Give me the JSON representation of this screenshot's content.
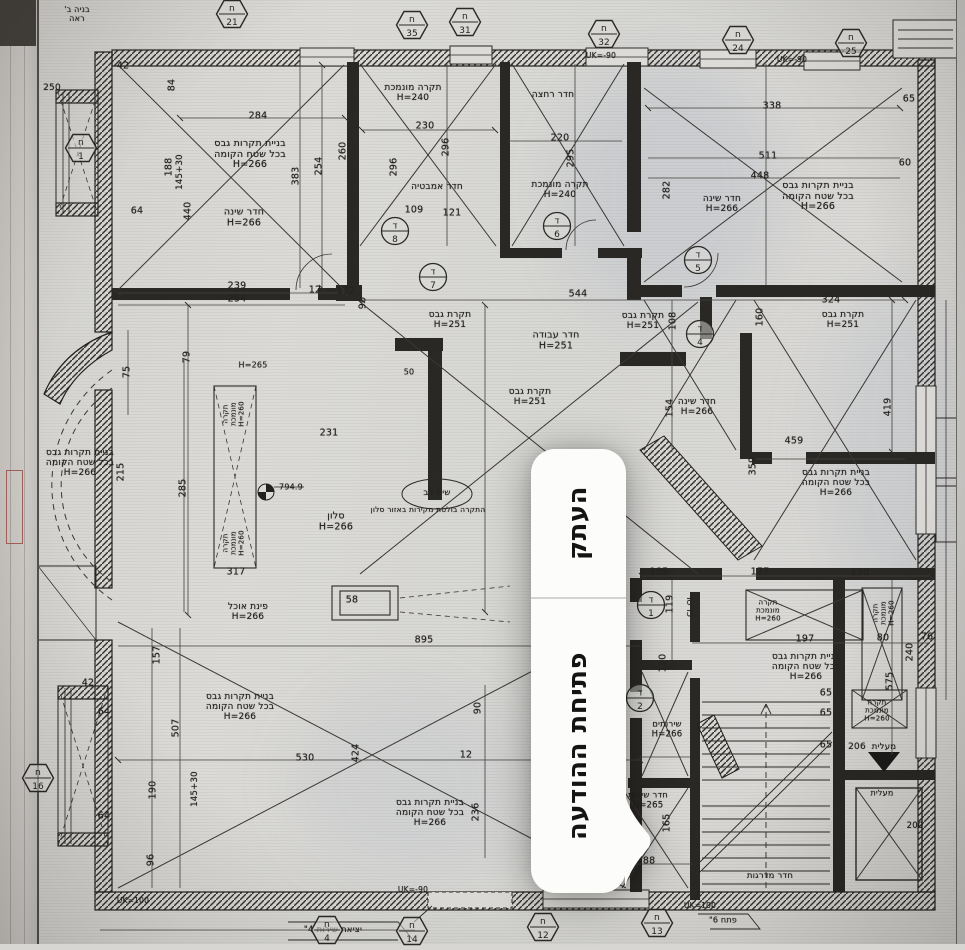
{
  "context_menu": {
    "items": [
      {
        "label": "העתק"
      },
      {
        "label": "פתיחת ההודעה"
      }
    ]
  },
  "plan": {
    "labels": [
      {
        "t": "בניית תקרות גבס\nבכל שטח הקומה\nH=266",
        "x": 250,
        "y": 155
      },
      {
        "t": "בניית תקרות גבס\nבכל שטח הקומה\nH=266",
        "x": 818,
        "y": 197
      },
      {
        "t": "בניית תקרות גבס\nבכל שטח הקומה\nH=266",
        "x": 80,
        "y": 463,
        "s": 9
      },
      {
        "t": "בניית תקרות גבס\nבכל שטח הקומה\nH=266",
        "x": 836,
        "y": 483,
        "s": 9
      },
      {
        "t": "בניית תקרות גבס\nבכל שטח הקומה\nH=266",
        "x": 806,
        "y": 667,
        "s": 9
      },
      {
        "t": "בניית תקרות גבס\nבכל שטח הקומה\nH=266",
        "x": 240,
        "y": 707,
        "s": 9
      },
      {
        "t": "בניית תקרות גבס\nבכל שטח הקומה\nH=266",
        "x": 430,
        "y": 813,
        "s": 9
      },
      {
        "t": "חדר שינה\nH=266",
        "x": 244,
        "y": 218
      },
      {
        "t": "חדר שינה\nH=266",
        "x": 722,
        "y": 204,
        "s": 9
      },
      {
        "t": "חדר שינה\nH=266",
        "x": 697,
        "y": 407,
        "s": 9
      },
      {
        "t": "חדר עבודה\nH=251",
        "x": 556,
        "y": 341
      },
      {
        "t": "תקרת גבס\nH=251",
        "x": 450,
        "y": 320,
        "s": 9
      },
      {
        "t": "תקרת גבס\nH=251",
        "x": 643,
        "y": 321,
        "s": 9
      },
      {
        "t": "תקרת גבס\nH=251",
        "x": 530,
        "y": 397,
        "s": 9
      },
      {
        "t": "תקרת גבס\nH=251",
        "x": 843,
        "y": 320,
        "s": 9
      },
      {
        "t": "תקרה מונמכת\nH=240",
        "x": 413,
        "y": 93,
        "s": 9
      },
      {
        "t": "תקרה מונמכת\nH=240",
        "x": 560,
        "y": 190,
        "s": 9
      },
      {
        "t": "חדר רחצה",
        "x": 553,
        "y": 95,
        "s": 9
      },
      {
        "t": "חדר אמבטיה",
        "x": 437,
        "y": 187,
        "s": 9
      },
      {
        "t": "סלון\nH=266",
        "x": 336,
        "y": 522
      },
      {
        "t": "פינת אוכל\nH=266",
        "x": 248,
        "y": 612,
        "s": 9
      },
      {
        "t": "שירותים\nH=266",
        "x": 667,
        "y": 730,
        "s": 8.5
      },
      {
        "t": "חדר שירות\nH=265",
        "x": 648,
        "y": 801,
        "s": 8.5
      },
      {
        "t": "חדר מדרגות",
        "x": 770,
        "y": 877,
        "s": 8.5
      },
      {
        "t": "מעלית",
        "x": 884,
        "y": 748,
        "s": 8.5
      },
      {
        "t": "206",
        "x": 857,
        "y": 747,
        "s": 9
      },
      {
        "t": "מעלית",
        "x": 882,
        "y": 794,
        "s": 8
      },
      {
        "t": "200",
        "x": 915,
        "y": 827,
        "s": 8.5
      },
      {
        "t": "שים לב",
        "x": 437,
        "y": 494,
        "s": 8.5
      },
      {
        "t": "התקרה בולטת מקירות באזור סלון",
        "x": 428,
        "y": 510,
        "s": 7.5
      },
      {
        "t": "794.9",
        "x": 291,
        "y": 488,
        "s": 8
      },
      {
        "t": "H=265",
        "x": 253,
        "y": 366,
        "s": 8
      },
      {
        "t": "יציאת שירות 4\"",
        "x": 333,
        "y": 931,
        "s": 8.5
      },
      {
        "t": "פתח 6\"",
        "x": 723,
        "y": 921,
        "s": 8
      },
      {
        "t": "UK=100",
        "x": 133,
        "y": 901,
        "s": 7.5
      },
      {
        "t": "UK=-90",
        "x": 413,
        "y": 890,
        "s": 7.5
      },
      {
        "t": "UK=100",
        "x": 700,
        "y": 906,
        "s": 7.5
      },
      {
        "t": "UK=-90",
        "x": 601,
        "y": 56,
        "s": 7.5
      },
      {
        "t": "UK=-90",
        "x": 792,
        "y": 60,
        "s": 7.5
      },
      {
        "t": "CL.OL",
        "x": 691,
        "y": 606,
        "r": -90,
        "s": 7
      },
      {
        "t": "תקרה\nמונמכת\nH=260",
        "x": 768,
        "y": 611,
        "s": 7
      },
      {
        "t": "תקרה\nמונמכת\nH=260",
        "x": 884,
        "y": 613,
        "r": -90,
        "s": 7
      },
      {
        "t": "תקרה\nמונמכת\nH=260",
        "x": 877,
        "y": 711,
        "s": 7
      },
      {
        "t": "תקרה\nמונמכת\nH=260",
        "x": 234,
        "y": 414,
        "r": -90,
        "s": 7
      },
      {
        "t": "תקרה\nמונמכת\nH=260",
        "x": 234,
        "y": 543,
        "r": -90,
        "s": 7
      },
      {
        "t": "בניה ב'\nראה",
        "x": 77,
        "y": 15,
        "s": 8
      },
      {
        "t": "250",
        "x": 52,
        "y": 88,
        "s": 9
      },
      {
        "t": "284",
        "x": 258,
        "y": 117
      },
      {
        "t": "230",
        "x": 425,
        "y": 127
      },
      {
        "t": "220",
        "x": 560,
        "y": 139
      },
      {
        "t": "338",
        "x": 772,
        "y": 107
      },
      {
        "t": "511",
        "x": 768,
        "y": 157
      },
      {
        "t": "448",
        "x": 760,
        "y": 177
      },
      {
        "t": "239",
        "x": 237,
        "y": 287
      },
      {
        "t": "254",
        "x": 237,
        "y": 300
      },
      {
        "t": "12",
        "x": 315,
        "y": 291
      },
      {
        "t": "132",
        "x": 346,
        "y": 292
      },
      {
        "t": "544",
        "x": 578,
        "y": 295
      },
      {
        "t": "324",
        "x": 831,
        "y": 301
      },
      {
        "t": "109",
        "x": 414,
        "y": 211
      },
      {
        "t": "121",
        "x": 452,
        "y": 214
      },
      {
        "t": "65",
        "x": 909,
        "y": 100
      },
      {
        "t": "60",
        "x": 905,
        "y": 164
      },
      {
        "t": "459",
        "x": 794,
        "y": 442
      },
      {
        "t": "231",
        "x": 329,
        "y": 434
      },
      {
        "t": "895",
        "x": 424,
        "y": 641
      },
      {
        "t": "58",
        "x": 352,
        "y": 601
      },
      {
        "t": "530",
        "x": 305,
        "y": 759
      },
      {
        "t": "12",
        "x": 466,
        "y": 756
      },
      {
        "t": "190",
        "x": 606,
        "y": 756
      },
      {
        "t": "188",
        "x": 646,
        "y": 862
      },
      {
        "t": "185",
        "x": 659,
        "y": 573
      },
      {
        "t": "177",
        "x": 760,
        "y": 573
      },
      {
        "t": "150",
        "x": 860,
        "y": 574
      },
      {
        "t": "197",
        "x": 805,
        "y": 640
      },
      {
        "t": "80",
        "x": 883,
        "y": 639
      },
      {
        "t": "76",
        "x": 927,
        "y": 638
      },
      {
        "t": "65",
        "x": 826,
        "y": 694
      },
      {
        "t": "65",
        "x": 826,
        "y": 714
      },
      {
        "t": "65",
        "x": 826,
        "y": 746
      },
      {
        "t": "42",
        "x": 88,
        "y": 684
      },
      {
        "t": "64",
        "x": 104,
        "y": 713
      },
      {
        "t": "64",
        "x": 104,
        "y": 817
      },
      {
        "t": "42",
        "x": 123,
        "y": 67
      },
      {
        "t": "64",
        "x": 137,
        "y": 212
      },
      {
        "t": "317",
        "x": 236,
        "y": 573
      },
      {
        "t": "50",
        "x": 409,
        "y": 373,
        "s": 8
      },
      {
        "t": "96",
        "x": 152,
        "y": 860,
        "r": -90
      },
      {
        "t": "157",
        "x": 158,
        "y": 655,
        "r": -90
      },
      {
        "t": "507",
        "x": 177,
        "y": 728,
        "r": -90
      },
      {
        "t": "145+30",
        "x": 196,
        "y": 789,
        "r": -90,
        "s": 8.5
      },
      {
        "t": "190",
        "x": 154,
        "y": 790,
        "r": -90
      },
      {
        "t": "424",
        "x": 357,
        "y": 753,
        "r": -90
      },
      {
        "t": "236",
        "x": 477,
        "y": 812,
        "r": -90
      },
      {
        "t": "90",
        "x": 479,
        "y": 708,
        "r": -90
      },
      {
        "t": "75",
        "x": 128,
        "y": 372,
        "r": -90
      },
      {
        "t": "79",
        "x": 188,
        "y": 357,
        "r": -90
      },
      {
        "t": "215",
        "x": 122,
        "y": 472,
        "r": -90
      },
      {
        "t": "285",
        "x": 184,
        "y": 488,
        "r": -90
      },
      {
        "t": "188",
        "x": 170,
        "y": 167,
        "r": -90
      },
      {
        "t": "145+30",
        "x": 181,
        "y": 172,
        "r": -90,
        "s": 8.5
      },
      {
        "t": "440",
        "x": 189,
        "y": 211,
        "r": -90
      },
      {
        "t": "84",
        "x": 173,
        "y": 85,
        "r": -90
      },
      {
        "t": "254",
        "x": 320,
        "y": 166,
        "r": -90
      },
      {
        "t": "260",
        "x": 344,
        "y": 151,
        "r": -90
      },
      {
        "t": "296",
        "x": 395,
        "y": 167,
        "r": -90
      },
      {
        "t": "296",
        "x": 447,
        "y": 147,
        "r": -90
      },
      {
        "t": "295",
        "x": 572,
        "y": 158,
        "r": -90
      },
      {
        "t": "383",
        "x": 297,
        "y": 176,
        "r": -90
      },
      {
        "t": "282",
        "x": 668,
        "y": 190,
        "r": -90
      },
      {
        "t": "108",
        "x": 674,
        "y": 321,
        "r": -90
      },
      {
        "t": "160",
        "x": 761,
        "y": 317,
        "r": -90
      },
      {
        "t": "154",
        "x": 671,
        "y": 408,
        "r": -90
      },
      {
        "t": "359",
        "x": 754,
        "y": 466,
        "r": -90
      },
      {
        "t": "419",
        "x": 889,
        "y": 407,
        "r": -90
      },
      {
        "t": "575",
        "x": 891,
        "y": 681,
        "r": -90
      },
      {
        "t": "240",
        "x": 911,
        "y": 652,
        "r": -90
      },
      {
        "t": "119",
        "x": 671,
        "y": 604,
        "r": -90
      },
      {
        "t": "110",
        "x": 664,
        "y": 663,
        "r": -90
      },
      {
        "t": "165",
        "x": 668,
        "y": 823,
        "r": -90
      },
      {
        "t": "90",
        "x": 364,
        "y": 303,
        "r": -90
      }
    ],
    "axis_markers": [
      {
        "letter": "ח",
        "n": "21",
        "x": 232,
        "y": 16
      },
      {
        "letter": "ח",
        "n": "35",
        "x": 412,
        "y": 27
      },
      {
        "letter": "ח",
        "n": "31",
        "x": 465,
        "y": 24
      },
      {
        "letter": "ח",
        "n": "32",
        "x": 604,
        "y": 36
      },
      {
        "letter": "ח",
        "n": "24",
        "x": 738,
        "y": 42
      },
      {
        "letter": "ח",
        "n": "25",
        "x": 851,
        "y": 45
      },
      {
        "letter": "ח",
        "n": "1",
        "x": 81,
        "y": 150
      },
      {
        "letter": "ח",
        "n": "16",
        "x": 38,
        "y": 780
      },
      {
        "letter": "ח",
        "n": "4",
        "x": 327,
        "y": 932
      },
      {
        "letter": "ח",
        "n": "14",
        "x": 412,
        "y": 933
      },
      {
        "letter": "ח",
        "n": "12",
        "x": 543,
        "y": 929
      },
      {
        "letter": "ח",
        "n": "13",
        "x": 657,
        "y": 925
      }
    ],
    "door_tags": [
      {
        "letter": "ד",
        "n": "8",
        "x": 395,
        "y": 233
      },
      {
        "letter": "ד",
        "n": "7",
        "x": 433,
        "y": 279
      },
      {
        "letter": "ד",
        "n": "6",
        "x": 557,
        "y": 228
      },
      {
        "letter": "ד",
        "n": "5",
        "x": 698,
        "y": 262
      },
      {
        "letter": "ד",
        "n": "4",
        "x": 700,
        "y": 336
      },
      {
        "letter": "ד",
        "n": "1",
        "x": 651,
        "y": 607
      },
      {
        "letter": "ד",
        "n": "2",
        "x": 640,
        "y": 700
      }
    ]
  },
  "colors": {
    "paper": "#d7d6d2",
    "ink": "#23211e",
    "menu_bg": "#fcfcfb",
    "menu_divider": "#d4d3d1",
    "menu_text": "#141414"
  }
}
